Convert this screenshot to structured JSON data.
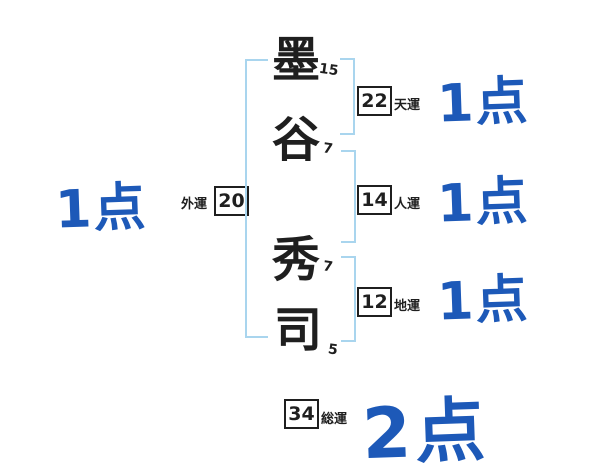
{
  "name_chars": [
    {
      "char": "墨",
      "strokes": "15"
    },
    {
      "char": "谷",
      "strokes": "7"
    },
    {
      "char": "秀",
      "strokes": "7"
    },
    {
      "char": "司",
      "strokes": "5"
    }
  ],
  "fortunes": {
    "gaiun": {
      "label": "外運",
      "value": "20",
      "score": "1点"
    },
    "tenun": {
      "label": "天運",
      "value": "22",
      "score": "1点"
    },
    "jinun": {
      "label": "人運",
      "value": "14",
      "score": "1点"
    },
    "chiun": {
      "label": "地運",
      "value": "12",
      "score": "1点"
    },
    "souun": {
      "label": "総運",
      "value": "34",
      "score": "2点"
    }
  },
  "colors": {
    "score_blue": "#1d59b8",
    "bracket_blue": "#a9d5ee",
    "ink": "#1f1f1f"
  }
}
